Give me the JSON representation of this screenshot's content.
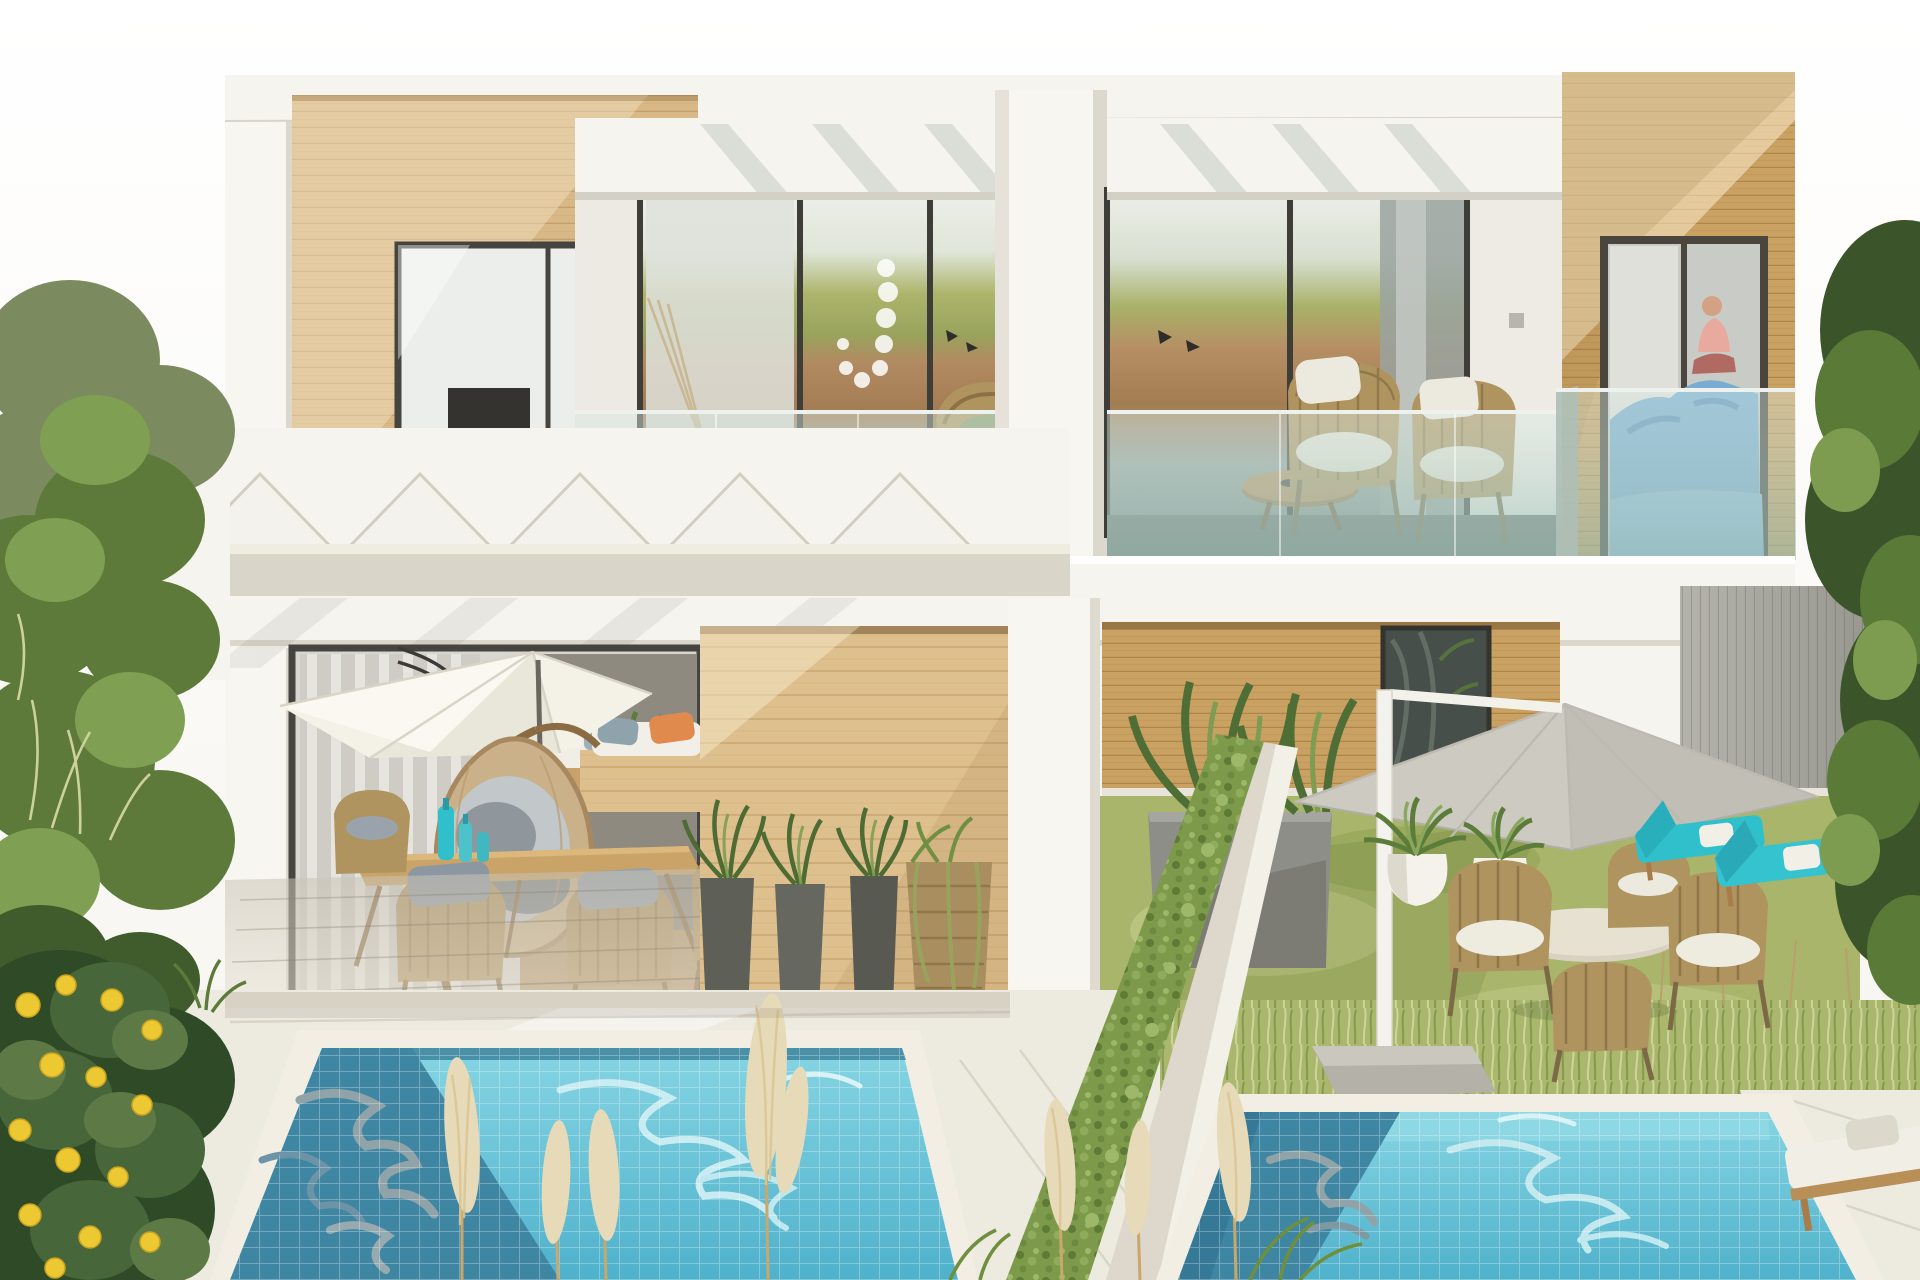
{
  "scene": {
    "title": "Bright daylight render of a modern two-storey duplex villa with wood-clad accents, furnished balconies, private gardens and two tiled plunge pools",
    "style": "photorealistic architectural exterior render",
    "time_of_day": "midday sun",
    "units": 2,
    "pools": 2,
    "pampas_plumes": 7,
    "lemon_count": 14,
    "elements": [
      {
        "name": "left-vegetation",
        "desc": "tall shrubs and olive-green trees along left edge"
      },
      {
        "name": "lemon-tree",
        "desc": "lemon tree with yellow fruit, bottom left corner"
      },
      {
        "name": "upper-left-wood-facade",
        "desc": "pale horizontal timber cladding on upper left volume"
      },
      {
        "name": "upper-left-window",
        "desc": "sliding glass door showing shelving, TV and chaise"
      },
      {
        "name": "left-balcony",
        "desc": "terrace with cream hammock with yellow fringe and grey pillows"
      },
      {
        "name": "glass-railings",
        "desc": "frameless teal glass balustrades on both terraces"
      },
      {
        "name": "central-pillar",
        "desc": "white pier dividing the two balconies"
      },
      {
        "name": "right-balcony",
        "desc": "two rope-weave armchairs with white cushions and round coffee table"
      },
      {
        "name": "right-bedroom-window",
        "desc": "golden timber volume, bedroom with blue bedding and seated person"
      },
      {
        "name": "pergola",
        "desc": "white triangular trusses over concrete beam above left patio"
      },
      {
        "name": "left-patio",
        "desc": "white parasol, hanging egg chair, daybed, timber dining table with turquoise bottles and four wicker chairs"
      },
      {
        "name": "center-wood-wall",
        "desc": "timber screen wall with dark planters and rattan basket pot"
      },
      {
        "name": "divider-hedge",
        "desc": "diagonal white wall capped with trailing greenery separating the plots"
      },
      {
        "name": "right-garden",
        "desc": "lawn with grey cantilever parasol, round bistro table, wicker chairs, white egg planters and turquoise sun loungers"
      },
      {
        "name": "right-fence",
        "desc": "grey vertical-slat privacy fence"
      },
      {
        "name": "left-pool",
        "desc": "tiled turquoise pool, left half in building shadow"
      },
      {
        "name": "right-pool",
        "desc": "smaller tiled plunge pool with sunlit ripples"
      },
      {
        "name": "pampas-grass",
        "desc": "cream pampas plumes in foreground"
      },
      {
        "name": "pool-deck",
        "desc": "pale stone pavers surrounding pools"
      },
      {
        "name": "wood-lounger",
        "desc": "timber lounger with white cushion, bottom right"
      }
    ]
  },
  "colors": {
    "wall": "#f6f4ef",
    "wall_shade": "#e9e5dc",
    "pillar": "#f8f6f1",
    "coping": "#f2eee3",
    "deck": "#edeadf",
    "deck_gray": "#ccc6ba",
    "lawn": "#a9b56a",
    "hedge": "#7d9a4a",
    "pool_lit": "#6ecadd",
    "pool_shadow": "#3f86a3",
    "hammock": "#ecdebc",
    "fringe_yellow": "#dcc066",
    "wicker": "#b0945f",
    "cushion_gray": "#97a1ab",
    "umbrella_white": "#f4f1e7",
    "umbrella_gray": "#cdcac1",
    "turquoise": "#2fc0cc",
    "orange": "#e08a4e",
    "lemon": "#ecc832",
    "bed_blue": "#79add0",
    "skin": "#d3a183",
    "pink": "#e8a99e",
    "wood_light": "#d8b887",
    "wood_gold": "#c9a162",
    "frame_dark": "#3f3d38",
    "leaf_dark": "#415c2c",
    "leaf_mid": "#5d7a3a",
    "leaf_light": "#7fa052"
  }
}
